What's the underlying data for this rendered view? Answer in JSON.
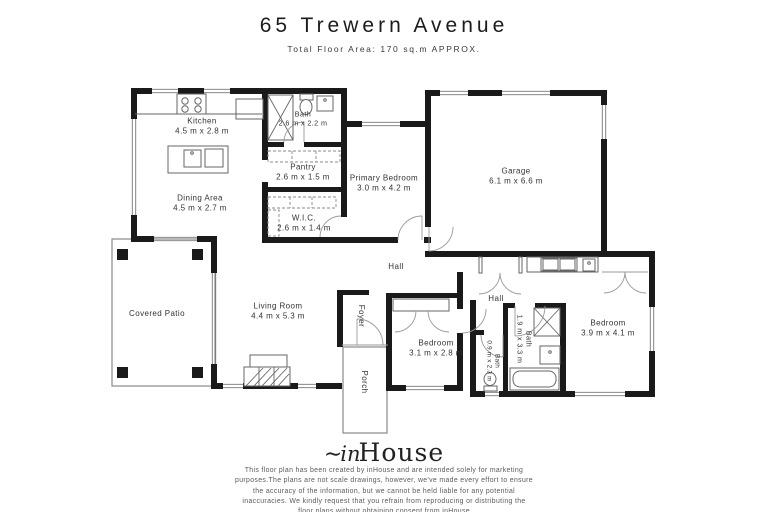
{
  "title": "65 Trewern Avenue",
  "subtitle": "Total Floor Area: 170 sq.m APPROX.",
  "rooms": {
    "kitchen": {
      "name": "Kitchen",
      "dims": "4.5 m x 2.8 m"
    },
    "bath_top": {
      "name": "Bath",
      "dims": "2.6 m x 2.2 m"
    },
    "pantry": {
      "name": "Pantry",
      "dims": "2.6 m x 1.5 m"
    },
    "dining_area": {
      "name": "Dining Area",
      "dims": "4.5 m x 2.7 m"
    },
    "wic": {
      "name": "W.I.C.",
      "dims": "2.6 m x 1.4 m"
    },
    "primary_bedroom": {
      "name": "Primary Bedroom",
      "dims": "3.0 m x 4.2 m"
    },
    "garage": {
      "name": "Garage",
      "dims": "6.1 m x 6.6 m"
    },
    "hall": {
      "name": "Hall"
    },
    "covered_patio": {
      "name": "Covered Patio"
    },
    "living_room": {
      "name": "Living Room",
      "dims": "4.4 m x 5.3 m"
    },
    "foyer": {
      "name": "Foyer"
    },
    "porch": {
      "name": "Porch"
    },
    "rear_hall": {
      "name": "Hall"
    },
    "bedroom_2": {
      "name": "Bedroom",
      "dims": "3.1 m x 2.8 m"
    },
    "bath_rear": {
      "name": "Bath",
      "dims": "1.9 m x 3.3 m"
    },
    "bath_small": {
      "name": "Bath",
      "dims": "0.9 m x 2.3 m"
    },
    "bedroom_3": {
      "name": "Bedroom",
      "dims": "3.9 m x 4.1 m"
    }
  },
  "branding": {
    "logo_swash": "∼",
    "logo_in": "in",
    "logo_house": "House"
  },
  "footer": {
    "disclaimer": "This floor plan has been created by inHouse and are intended solely for marketing\npurposes.The plans are not scale drawings, however, we've made every effort to ensure\nthe accuracy of the information, but we cannot be held liable for any potential\ninaccuracies. We kindly request that you refrain from reproducing or distributing the\nfloor plans without obtaining consent from inHouse"
  },
  "colors": {
    "wall": "#1a1a1a",
    "text": "#333333",
    "muted": "#5b5b5b"
  }
}
